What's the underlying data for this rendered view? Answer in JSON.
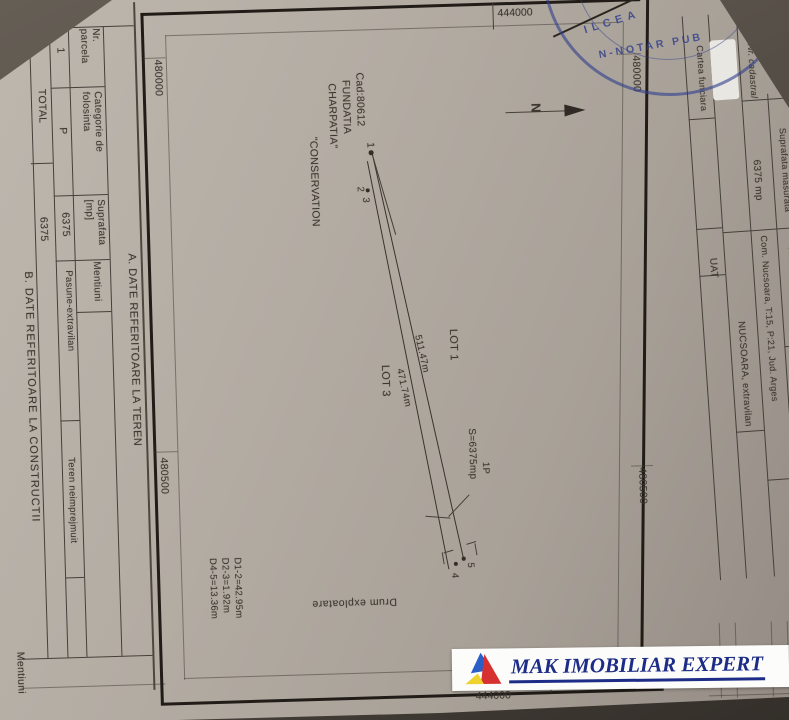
{
  "colors": {
    "paper": "#b3aca3",
    "ink": "#3b362f",
    "frame": "#211c17",
    "stamp_blue": "#2a3a8a",
    "watermark_navy": "#1d2c86",
    "logo_blue": "#2b5fc7",
    "logo_red": "#d63031",
    "logo_yellow": "#efd22e"
  },
  "left_table": {
    "section_a_title": "A. DATE REFERITOARE LA TEREN",
    "section_b_title": "B. DATE REFERITOARE LA CONSTRUCTII",
    "col_nr": "Nr.\nparcela",
    "col_categorie": "Categorie de\nfolosinta",
    "col_suprafata": "Suprafata\n[mp]",
    "col_mentiuni": "Mentiuni",
    "row_nr": "1",
    "row_categorie": "P",
    "row_suprafata": "6375",
    "row_folosinta": "Pasune-extravilan",
    "row_mentiuni": "Teren neimprejmuit",
    "total_label": "TOTAL",
    "total_value": "6375",
    "bottom_partial": "Mentiuni"
  },
  "map": {
    "coord_top": "444000",
    "coord_bottom": "444000",
    "coord_left_top": "480000",
    "coord_left_bottom": "480500",
    "coord_right_top": "480000",
    "coord_right_bottom": "480500",
    "north": "N",
    "cad_lines": [
      "Cad:80612",
      "FUNDATIA",
      "CHARPATIA\"",
      "\"CONSERVATION"
    ],
    "lot1": "LOT 1",
    "lot3": "LOT 3",
    "len_a": "511.47m",
    "len_b": "471.74m",
    "area": "S=6375mp",
    "parcel": "1P",
    "pt1": "1",
    "pt2": "2",
    "pt3": "3",
    "pt4": "4",
    "pt5": "5",
    "dims": "D1-2=42.95m\nD2-3=1.92m\nD4-5=13.36m",
    "road": "Drum exploatare"
  },
  "right_table": {
    "cartea_funciara": "Cartea funciara",
    "uat_label": "UAT",
    "uat_value": "NUCSOARA,  extravilan",
    "nr_cadastral": "Nr. cadastral",
    "suprafata_label": "Suprafata masurată",
    "suprafata_value": "6375 mp",
    "adresa_label": "Adresa imobilului",
    "adresa_value": "Com. Nucsoara, T:15, P:21, Jud. Arges"
  },
  "stamp": {
    "text_outer": "ILCEA",
    "text_inner": "N-NOTAR PUB"
  },
  "watermark": {
    "text": "MAK IMOBILIAR EXPERT"
  }
}
